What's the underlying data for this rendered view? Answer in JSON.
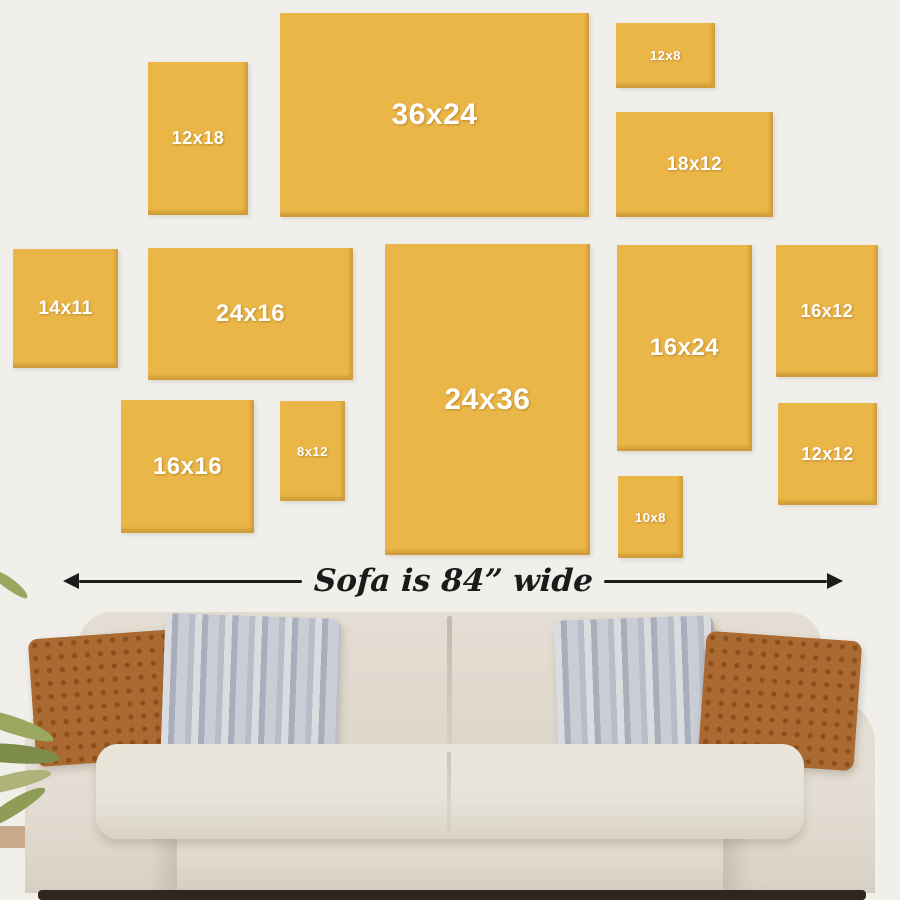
{
  "title": "Canvas size comparison above sofa",
  "frames": [
    {
      "label": "12x18",
      "x": 148,
      "y": 62,
      "w": 100,
      "h": 153
    },
    {
      "label": "36x24",
      "x": 280,
      "y": 13,
      "w": 309,
      "h": 204
    },
    {
      "label": "12x8",
      "x": 616,
      "y": 23,
      "w": 99,
      "h": 65
    },
    {
      "label": "18x12",
      "x": 616,
      "y": 112,
      "w": 157,
      "h": 105
    },
    {
      "label": "14x11",
      "x": 13,
      "y": 249,
      "w": 105,
      "h": 119
    },
    {
      "label": "24x16",
      "x": 148,
      "y": 248,
      "w": 205,
      "h": 132
    },
    {
      "label": "24x36",
      "x": 385,
      "y": 244,
      "w": 205,
      "h": 311
    },
    {
      "label": "16x24",
      "x": 617,
      "y": 245,
      "w": 135,
      "h": 206
    },
    {
      "label": "16x12",
      "x": 776,
      "y": 245,
      "w": 102,
      "h": 132
    },
    {
      "label": "16x16",
      "x": 121,
      "y": 400,
      "w": 133,
      "h": 133
    },
    {
      "label": "8x12",
      "x": 280,
      "y": 401,
      "w": 65,
      "h": 100
    },
    {
      "label": "10x8",
      "x": 618,
      "y": 476,
      "w": 65,
      "h": 82
    },
    {
      "label": "12x12",
      "x": 778,
      "y": 403,
      "w": 99,
      "h": 102
    }
  ],
  "measure": {
    "label": "Sofa is 84” wide"
  },
  "palette": {
    "bg": "#F1EFEA",
    "frame-fill": "#EAB648",
    "label-color": "#FFFFFF",
    "ink": "#1B1B1B",
    "sofa-body": "#E2DCD2",
    "sofa-back": "#E4DED4",
    "sofa-seat": "#E7E2D8",
    "sofa-skirt": "#DFD9CE",
    "pillow-rust": "#AA6A32",
    "pillow-gray": "#A8AEBC",
    "floor-dark": "#2F261E",
    "floor-wood": "#C8A98B",
    "leaf-green": "#8E9C55"
  }
}
